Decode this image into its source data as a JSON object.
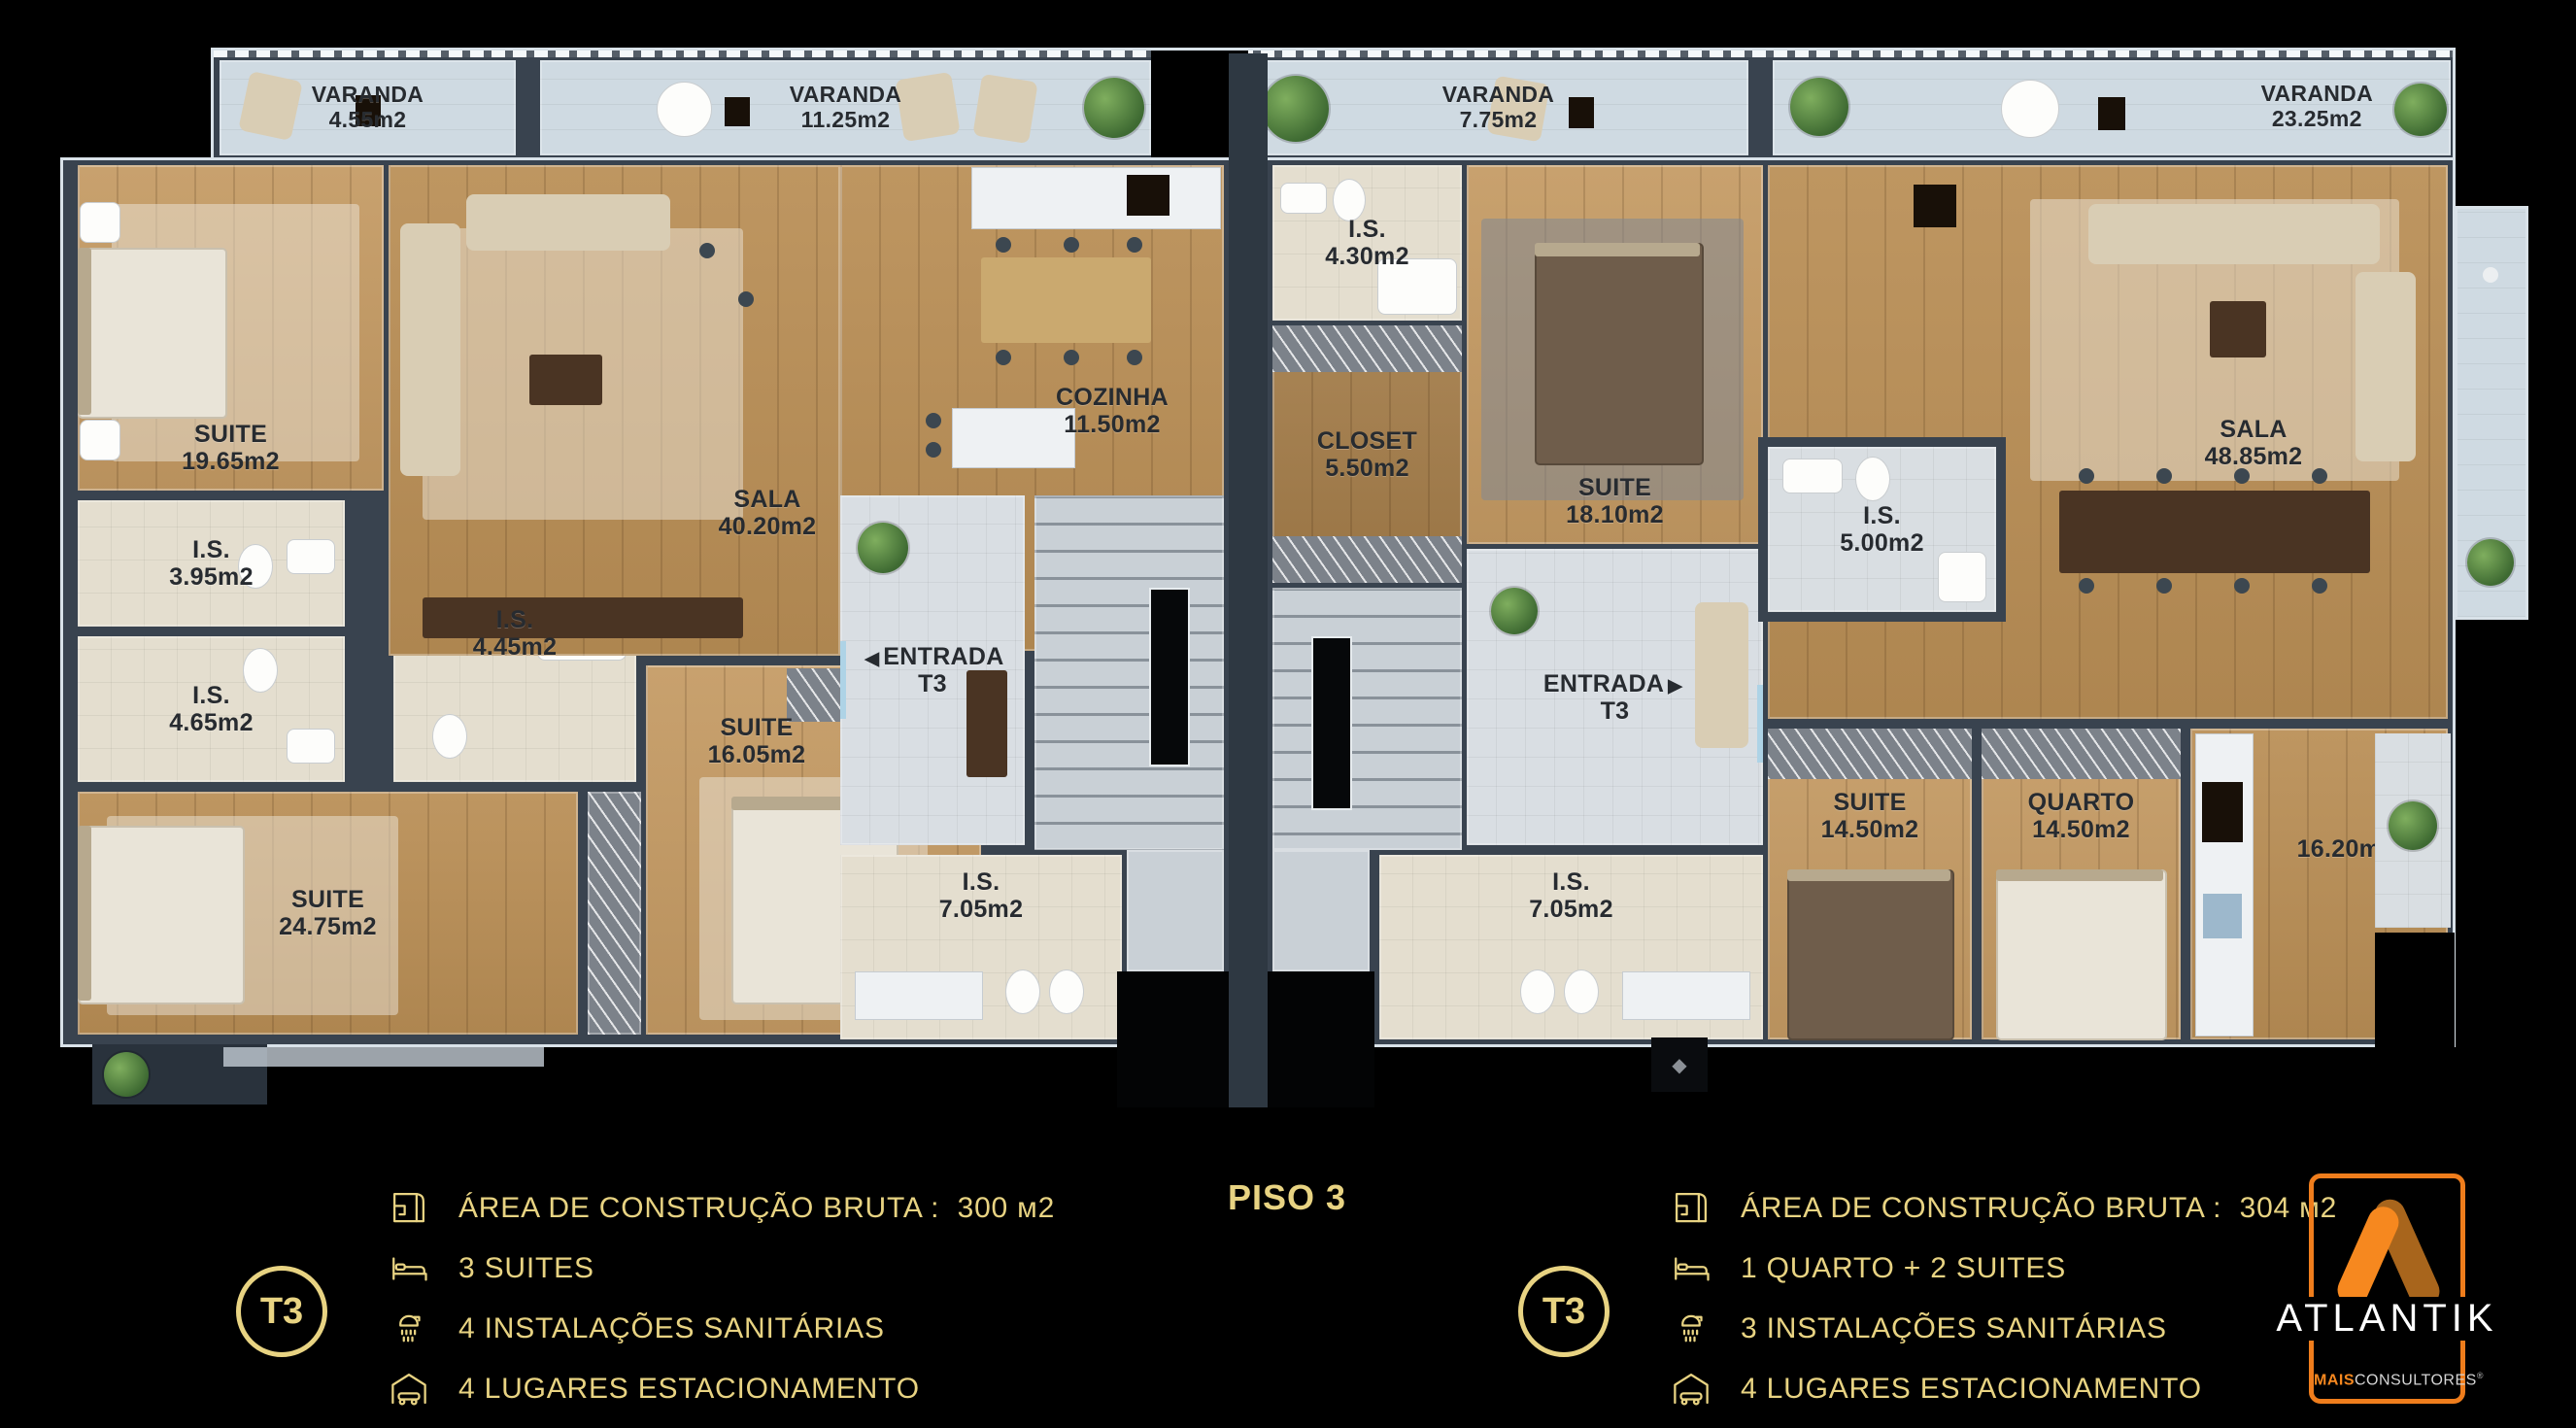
{
  "floor_plan": {
    "balconies": [
      {
        "name": "VARANDA",
        "area": "4.55m2"
      },
      {
        "name": "VARANDA",
        "area": "11.25m2"
      },
      {
        "name": "VARANDA",
        "area": "7.75m2"
      },
      {
        "name": "VARANDA",
        "area": "23.25m2"
      }
    ],
    "apartment_left": {
      "rooms": {
        "suite19": {
          "name": "SUITE",
          "area": "19.65m2"
        },
        "is395": {
          "name": "I.S.",
          "area": "3.95m2"
        },
        "is465": {
          "name": "I.S.",
          "area": "4.65m2"
        },
        "suite24": {
          "name": "SUITE",
          "area": "24.75m2"
        },
        "is445": {
          "name": "I.S.",
          "area": "4.45m2"
        },
        "suite16": {
          "name": "SUITE",
          "area": "16.05m2"
        },
        "sala": {
          "name": "SALA",
          "area": "40.20m2"
        },
        "cozinha": {
          "name": "COZINHA",
          "area": "11.50m2"
        },
        "entrada": {
          "name": "ENTRADA",
          "area": "T3",
          "arrow": "◀"
        },
        "is705": {
          "name": "I.S.",
          "area": "7.05m2"
        }
      }
    },
    "apartment_right": {
      "rooms": {
        "is430": {
          "name": "I.S.",
          "area": "4.30m2"
        },
        "closet": {
          "name": "CLOSET",
          "area": "5.50m2"
        },
        "suite18": {
          "name": "SUITE",
          "area": "18.10m2"
        },
        "is500": {
          "name": "I.S.",
          "area": "5.00m2"
        },
        "sala": {
          "name": "SALA",
          "area": "48.85m2"
        },
        "entrada": {
          "name": "ENTRADA",
          "area": "T3",
          "arrow": "▶"
        },
        "is705": {
          "name": "I.S.",
          "area": "7.05m2"
        },
        "suite14": {
          "name": "SUITE",
          "area": "14.50m2"
        },
        "quarto": {
          "name": "QUARTO",
          "area": "14.50m2"
        },
        "cozinha": {
          "name": "COZINHA",
          "area": "16.20m2"
        }
      }
    }
  },
  "footer": {
    "title": "PISO 3",
    "legend_left": {
      "badge": "T3",
      "rows": [
        {
          "icon": "blueprint-icon",
          "text": "ÁREA DE CONSTRUÇÃO BRUTA :  300 м2"
        },
        {
          "icon": "bed-icon",
          "text": "3 SUITES"
        },
        {
          "icon": "shower-icon",
          "text": "4 INSTALAÇÕES SANITÁRIAS"
        },
        {
          "icon": "car-garage-icon",
          "text": "4 LUGARES ESTACIONAMENTO"
        }
      ]
    },
    "legend_right": {
      "badge": "T3",
      "rows": [
        {
          "icon": "blueprint-icon",
          "text": "ÁREA DE CONSTRUÇÃO BRUTA :  304 м2"
        },
        {
          "icon": "bed-icon",
          "text": "1 QUARTO + 2 SUITES"
        },
        {
          "icon": "shower-icon",
          "text": "3 INSTALAÇÕES SANITÁRIAS"
        },
        {
          "icon": "car-garage-icon",
          "text": "4 LUGARES ESTACIONAMENTO"
        }
      ]
    },
    "logo": {
      "brand": "ATLANTIK",
      "sub_bold": "MAIS",
      "sub_rest": "CONSULTORES",
      "reg": "®"
    }
  },
  "colors": {
    "background": "#000000",
    "legend_gold": "#e8d382",
    "logo_orange": "#f6881f",
    "logo_orange_dark": "#a8651c",
    "wall": "#39434f",
    "wood": "#b98e55",
    "balcony": "#cfdae2"
  }
}
